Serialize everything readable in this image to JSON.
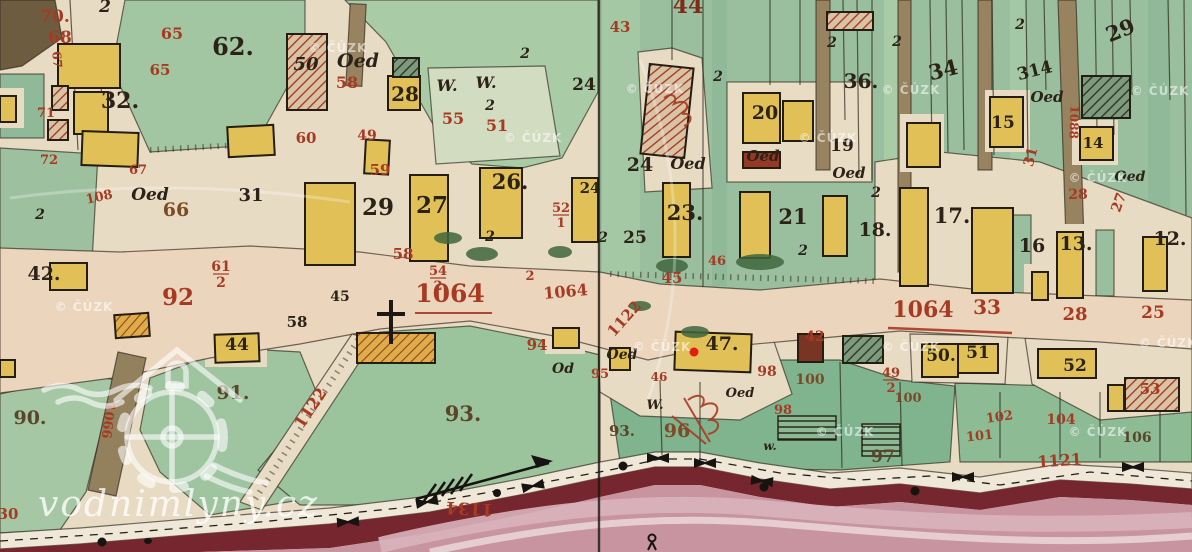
{
  "map": {
    "colors": {
      "paper": "#e8dbc4",
      "ink_black": "#2b2218",
      "ink_red": "#a63a22",
      "ink_brown": "#7d4a26",
      "building_yellow": "#e0c057",
      "parcel_green": "#9cc2a0",
      "river_pink": "#c794a0",
      "river_dark": "#76262e",
      "marker_red": "#e21d12"
    },
    "labels": [
      {
        "t": "2",
        "x": 105,
        "y": 12,
        "s": 17,
        "c": "k",
        "i": 1
      },
      {
        "t": "62.",
        "x": 233,
        "y": 55,
        "s": 24,
        "c": "k"
      },
      {
        "t": "32.",
        "x": 120,
        "y": 108,
        "s": 22,
        "c": "k"
      },
      {
        "t": "50",
        "x": 306,
        "y": 70,
        "s": 18,
        "c": "k",
        "i": 1
      },
      {
        "t": "Oed",
        "x": 358,
        "y": 67,
        "s": 19,
        "c": "k",
        "i": 1
      },
      {
        "t": "28",
        "x": 405,
        "y": 101,
        "s": 20,
        "c": "k"
      },
      {
        "t": "W.",
        "x": 447,
        "y": 91,
        "s": 16,
        "c": "k",
        "i": 1
      },
      {
        "t": "W.",
        "x": 486,
        "y": 88,
        "s": 16,
        "c": "k",
        "i": 1
      },
      {
        "t": "2",
        "x": 490,
        "y": 110,
        "s": 14,
        "c": "k",
        "i": 1
      },
      {
        "t": "24",
        "x": 584,
        "y": 90,
        "s": 17,
        "c": "k"
      },
      {
        "t": "44",
        "x": 688,
        "y": 13,
        "s": 22,
        "c": "d"
      },
      {
        "t": "24",
        "x": 640,
        "y": 171,
        "s": 19,
        "c": "k"
      },
      {
        "t": "Oed",
        "x": 688,
        "y": 169,
        "s": 16,
        "c": "k",
        "i": 1
      },
      {
        "t": "Oed",
        "x": 763,
        "y": 161,
        "s": 15,
        "c": "k",
        "i": 1
      },
      {
        "t": "20",
        "x": 765,
        "y": 119,
        "s": 19,
        "c": "k"
      },
      {
        "t": "19",
        "x": 842,
        "y": 151,
        "s": 17,
        "c": "k"
      },
      {
        "t": "Oed",
        "x": 849,
        "y": 178,
        "s": 15,
        "c": "k",
        "i": 1
      },
      {
        "t": "36.",
        "x": 861,
        "y": 88,
        "s": 20,
        "c": "k"
      },
      {
        "t": "34",
        "x": 945,
        "y": 77,
        "s": 21,
        "c": "k",
        "r": -14
      },
      {
        "t": "314",
        "x": 1036,
        "y": 76,
        "s": 17,
        "c": "k",
        "r": -14
      },
      {
        "t": "29",
        "x": 1123,
        "y": 37,
        "s": 21,
        "c": "k",
        "r": -22
      },
      {
        "t": "Oed",
        "x": 1047,
        "y": 102,
        "s": 15,
        "c": "k",
        "i": 1
      },
      {
        "t": "15",
        "x": 1003,
        "y": 128,
        "s": 17,
        "c": "k"
      },
      {
        "t": "14",
        "x": 1093,
        "y": 148,
        "s": 15,
        "c": "k"
      },
      {
        "t": "Oed",
        "x": 1130,
        "y": 181,
        "s": 14,
        "c": "k",
        "i": 1
      },
      {
        "t": "17.",
        "x": 952,
        "y": 223,
        "s": 21,
        "c": "k"
      },
      {
        "t": "16",
        "x": 1032,
        "y": 252,
        "s": 19,
        "c": "k"
      },
      {
        "t": "13.",
        "x": 1076,
        "y": 250,
        "s": 19,
        "c": "k"
      },
      {
        "t": "12.",
        "x": 1170,
        "y": 245,
        "s": 19,
        "c": "k"
      },
      {
        "t": "29",
        "x": 378,
        "y": 215,
        "s": 23,
        "c": "k"
      },
      {
        "t": "27",
        "x": 432,
        "y": 213,
        "s": 23,
        "c": "k"
      },
      {
        "t": "26.",
        "x": 510,
        "y": 189,
        "s": 21,
        "c": "k"
      },
      {
        "t": "24",
        "x": 590,
        "y": 193,
        "s": 15,
        "c": "k"
      },
      {
        "t": "23.",
        "x": 685,
        "y": 220,
        "s": 21,
        "c": "k"
      },
      {
        "t": "25",
        "x": 635,
        "y": 243,
        "s": 17,
        "c": "k"
      },
      {
        "t": "21",
        "x": 793,
        "y": 224,
        "s": 21,
        "c": "k"
      },
      {
        "t": "18.",
        "x": 875,
        "y": 236,
        "s": 19,
        "c": "k"
      },
      {
        "t": "31",
        "x": 251,
        "y": 201,
        "s": 18,
        "c": "k"
      },
      {
        "t": "42.",
        "x": 44,
        "y": 280,
        "s": 19,
        "c": "k"
      },
      {
        "t": "Oed",
        "x": 150,
        "y": 200,
        "s": 17,
        "c": "k",
        "i": 1
      },
      {
        "t": "45",
        "x": 340,
        "y": 301,
        "s": 14,
        "c": "k"
      },
      {
        "t": "58",
        "x": 297,
        "y": 327,
        "s": 15,
        "c": "k"
      },
      {
        "t": "90.",
        "x": 30,
        "y": 424,
        "s": 19,
        "c": "g"
      },
      {
        "t": "91.",
        "x": 233,
        "y": 399,
        "s": 19,
        "c": "g"
      },
      {
        "t": "44",
        "x": 237,
        "y": 350,
        "s": 17,
        "c": "k"
      },
      {
        "t": "93.",
        "x": 463,
        "y": 421,
        "s": 21,
        "c": "g"
      },
      {
        "t": "93.",
        "x": 622,
        "y": 436,
        "s": 15,
        "c": "g"
      },
      {
        "t": "47.",
        "x": 722,
        "y": 350,
        "s": 19,
        "c": "k"
      },
      {
        "t": "97",
        "x": 883,
        "y": 462,
        "s": 17,
        "c": "g"
      },
      {
        "t": "50.",
        "x": 941,
        "y": 361,
        "s": 17,
        "c": "k"
      },
      {
        "t": "51",
        "x": 978,
        "y": 358,
        "s": 17,
        "c": "k"
      },
      {
        "t": "52",
        "x": 1075,
        "y": 371,
        "s": 17,
        "c": "k"
      },
      {
        "t": "W.",
        "x": 655,
        "y": 409,
        "s": 13,
        "c": "k",
        "i": 1
      },
      {
        "t": "Oed",
        "x": 740,
        "y": 397,
        "s": 13,
        "c": "k",
        "i": 1
      },
      {
        "t": "Oed",
        "x": 622,
        "y": 359,
        "s": 14,
        "c": "k",
        "i": 1
      },
      {
        "t": "w.",
        "x": 770,
        "y": 450,
        "s": 12,
        "c": "k",
        "i": 1
      },
      {
        "t": "Od",
        "x": 563,
        "y": 373,
        "s": 14,
        "c": "k",
        "i": 1
      },
      {
        "t": "2",
        "x": 525,
        "y": 58,
        "s": 14,
        "c": "k",
        "i": 1
      },
      {
        "t": "2",
        "x": 832,
        "y": 47,
        "s": 14,
        "c": "k",
        "i": 1
      },
      {
        "t": "2",
        "x": 897,
        "y": 46,
        "s": 14,
        "c": "k",
        "i": 1
      },
      {
        "t": "2",
        "x": 1020,
        "y": 29,
        "s": 14,
        "c": "k",
        "i": 1
      },
      {
        "t": "2",
        "x": 803,
        "y": 255,
        "s": 14,
        "c": "k",
        "i": 1
      },
      {
        "t": "2",
        "x": 40,
        "y": 219,
        "s": 14,
        "c": "k",
        "i": 1
      },
      {
        "t": "2",
        "x": 876,
        "y": 197,
        "s": 14,
        "c": "k",
        "i": 1
      },
      {
        "t": "2",
        "x": 490,
        "y": 241,
        "s": 14,
        "c": "k",
        "i": 1
      },
      {
        "t": "2",
        "x": 718,
        "y": 81,
        "s": 14,
        "c": "k",
        "i": 1
      },
      {
        "t": "2",
        "x": 603,
        "y": 242,
        "s": 14,
        "c": "k",
        "i": 1
      },
      {
        "t": "70.",
        "x": 55,
        "y": 22,
        "s": 17,
        "c": "r"
      },
      {
        "t": "68",
        "x": 60,
        "y": 43,
        "s": 17,
        "c": "r"
      },
      {
        "t": "67",
        "x": 53,
        "y": 60,
        "s": 12,
        "c": "r",
        "r": 85
      },
      {
        "t": "65",
        "x": 172,
        "y": 39,
        "s": 16,
        "c": "r"
      },
      {
        "t": "65",
        "x": 160,
        "y": 75,
        "s": 15,
        "c": "r"
      },
      {
        "t": "71",
        "x": 46,
        "y": 117,
        "s": 13,
        "c": "r"
      },
      {
        "t": "72",
        "x": 49,
        "y": 164,
        "s": 13,
        "c": "r"
      },
      {
        "t": "58",
        "x": 347,
        "y": 88,
        "s": 16,
        "c": "r"
      },
      {
        "t": "60",
        "x": 306,
        "y": 143,
        "s": 15,
        "c": "r"
      },
      {
        "t": "49",
        "x": 367,
        "y": 140,
        "s": 14,
        "c": "r"
      },
      {
        "t": "59",
        "x": 380,
        "y": 175,
        "s": 15,
        "c": "r"
      },
      {
        "t": "55",
        "x": 453,
        "y": 124,
        "s": 16,
        "c": "r"
      },
      {
        "t": "51",
        "x": 497,
        "y": 131,
        "s": 16,
        "c": "r"
      },
      {
        "t": "43",
        "x": 620,
        "y": 32,
        "s": 15,
        "c": "r"
      },
      {
        "t": "52/1",
        "x": 561,
        "y": 214,
        "s": 13,
        "c": "r"
      },
      {
        "t": "58",
        "x": 403,
        "y": 259,
        "s": 15,
        "c": "r"
      },
      {
        "t": "54/2",
        "x": 438,
        "y": 277,
        "s": 13,
        "c": "r"
      },
      {
        "t": "2",
        "x": 530,
        "y": 280,
        "s": 13,
        "c": "r"
      },
      {
        "t": "1064",
        "x": 450,
        "y": 302,
        "s": 25,
        "c": "r"
      },
      {
        "t": "1064",
        "x": 566,
        "y": 297,
        "s": 16,
        "c": "r",
        "r": -5
      },
      {
        "t": "61/2",
        "x": 221,
        "y": 273,
        "s": 14,
        "c": "r"
      },
      {
        "t": "67",
        "x": 138,
        "y": 174,
        "s": 13,
        "c": "r"
      },
      {
        "t": "108",
        "x": 100,
        "y": 201,
        "s": 13,
        "c": "r",
        "r": -12
      },
      {
        "t": "66",
        "x": 176,
        "y": 216,
        "s": 19,
        "c": "b"
      },
      {
        "t": "92",
        "x": 178,
        "y": 305,
        "s": 23,
        "c": "r"
      },
      {
        "t": "1066",
        "x": 104,
        "y": 420,
        "s": 13,
        "c": "r",
        "r": 97
      },
      {
        "t": "1122",
        "x": 315,
        "y": 411,
        "s": 16,
        "c": "r",
        "r": -56
      },
      {
        "t": "30",
        "x": 8,
        "y": 519,
        "s": 15,
        "c": "r"
      },
      {
        "t": "1134",
        "x": 470,
        "y": 503,
        "s": 17,
        "c": "r",
        "r": 183
      },
      {
        "t": "94",
        "x": 537,
        "y": 350,
        "s": 15,
        "c": "r"
      },
      {
        "t": "45",
        "x": 672,
        "y": 283,
        "s": 15,
        "c": "r"
      },
      {
        "t": "46",
        "x": 717,
        "y": 265,
        "s": 13,
        "c": "r"
      },
      {
        "t": "1122",
        "x": 628,
        "y": 322,
        "s": 15,
        "c": "r",
        "r": -48
      },
      {
        "t": "95",
        "x": 600,
        "y": 378,
        "s": 13,
        "c": "r"
      },
      {
        "t": "96",
        "x": 677,
        "y": 437,
        "s": 19,
        "c": "b"
      },
      {
        "t": "98",
        "x": 767,
        "y": 376,
        "s": 14,
        "c": "r"
      },
      {
        "t": "98",
        "x": 783,
        "y": 414,
        "s": 13,
        "c": "r"
      },
      {
        "t": "46",
        "x": 659,
        "y": 381,
        "s": 12,
        "c": "r"
      },
      {
        "t": "100",
        "x": 810,
        "y": 384,
        "s": 14,
        "c": "b"
      },
      {
        "t": "100",
        "x": 908,
        "y": 402,
        "s": 13,
        "c": "b"
      },
      {
        "t": "49/2",
        "x": 891,
        "y": 379,
        "s": 13,
        "c": "r"
      },
      {
        "t": "42",
        "x": 815,
        "y": 341,
        "s": 14,
        "c": "r"
      },
      {
        "t": "102",
        "x": 1000,
        "y": 421,
        "s": 13,
        "c": "r",
        "r": -8
      },
      {
        "t": "101",
        "x": 980,
        "y": 440,
        "s": 13,
        "c": "r",
        "r": -6
      },
      {
        "t": "104",
        "x": 1061,
        "y": 424,
        "s": 14,
        "c": "r"
      },
      {
        "t": "106",
        "x": 1137,
        "y": 442,
        "s": 14,
        "c": "g"
      },
      {
        "t": "1121",
        "x": 1060,
        "y": 466,
        "s": 16,
        "c": "r",
        "r": -4
      },
      {
        "t": "53",
        "x": 1150,
        "y": 394,
        "s": 15,
        "c": "r"
      },
      {
        "t": "1064",
        "x": 923,
        "y": 317,
        "s": 22,
        "c": "r"
      },
      {
        "t": "33",
        "x": 987,
        "y": 314,
        "s": 20,
        "c": "r"
      },
      {
        "t": "28",
        "x": 1075,
        "y": 320,
        "s": 18,
        "c": "r"
      },
      {
        "t": "25",
        "x": 1153,
        "y": 318,
        "s": 17,
        "c": "r"
      },
      {
        "t": "28",
        "x": 1078,
        "y": 199,
        "s": 14,
        "c": "r"
      },
      {
        "t": "27",
        "x": 1123,
        "y": 204,
        "s": 14,
        "c": "r",
        "r": -70
      },
      {
        "t": "31",
        "x": 1035,
        "y": 158,
        "s": 14,
        "c": "r",
        "r": -75
      },
      {
        "t": "1088",
        "x": 1070,
        "y": 122,
        "s": 12,
        "c": "r",
        "r": 92
      }
    ],
    "watermarks": {
      "cuzk_text": "© ČÚZK",
      "site_text": "vodnimlyny.cz",
      "cuzk_positions": [
        {
          "x": 338,
          "y": 52
        },
        {
          "x": 655,
          "y": 93
        },
        {
          "x": 911,
          "y": 94
        },
        {
          "x": 1160,
          "y": 95
        },
        {
          "x": 533,
          "y": 142
        },
        {
          "x": 828,
          "y": 142
        },
        {
          "x": 1098,
          "y": 182
        },
        {
          "x": 84,
          "y": 311
        },
        {
          "x": 662,
          "y": 351
        },
        {
          "x": 911,
          "y": 351
        },
        {
          "x": 1168,
          "y": 347
        },
        {
          "x": 845,
          "y": 436
        },
        {
          "x": 1098,
          "y": 436
        }
      ]
    }
  }
}
